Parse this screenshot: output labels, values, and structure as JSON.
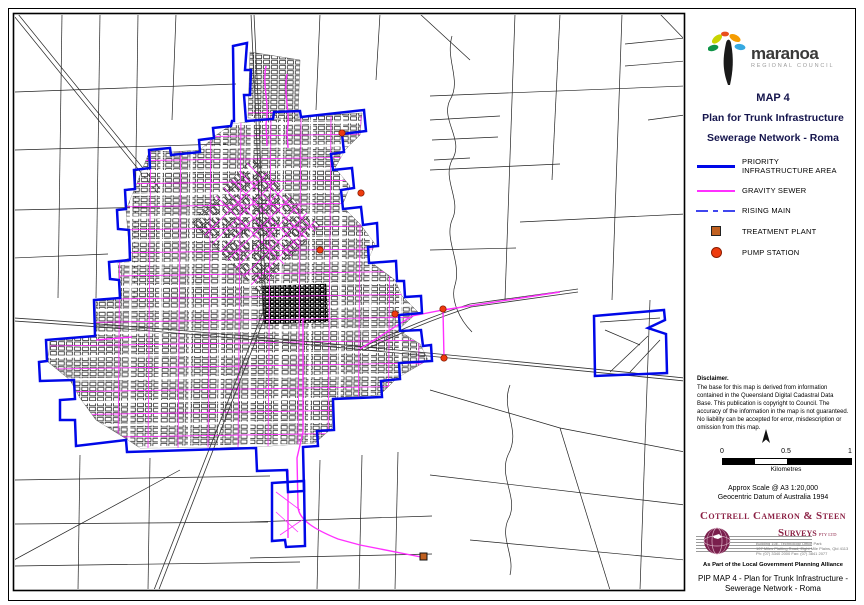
{
  "council_logo": {
    "name": "maranoa",
    "tagline": "REGIONAL COUNCIL"
  },
  "title_block": {
    "map_number": "MAP 4",
    "title": "Plan for Trunk Infrastructure",
    "subtitle": "Sewerage Network - Roma"
  },
  "legend": {
    "items": [
      {
        "id": "priority-infrastructure-area",
        "label": "PRIORITY INFRASTRUCTURE AREA"
      },
      {
        "id": "gravity-sewer",
        "label": "GRAVITY SEWER"
      },
      {
        "id": "rising-main",
        "label": "RISING MAIN"
      },
      {
        "id": "treatment-plant",
        "label": "TREATMENT PLANT"
      },
      {
        "id": "pump-station",
        "label": "PUMP STATION"
      }
    ]
  },
  "disclaimer": {
    "heading": "Disclaimer.",
    "body": "The base for this map is derived from information contained in the Queensland Digital Cadastral Data Base. This publication is copyright to Council. The accuracy of the information in the map is not guaranteed. No liability can be accepted for error, misdescription or omission from this map."
  },
  "scale_bar": {
    "tick_labels": [
      "0",
      "0.5",
      "1"
    ],
    "unit": "Kilometres"
  },
  "scale_notes": {
    "line1": "Approx Scale @ A3 1:20,000",
    "line2": "Geocentric Datum of Australia 1994"
  },
  "surveyor": {
    "name_line1": "Cottrell Cameron & Steen",
    "name_line2": "Surveys",
    "name_suffix": "PTY LTD",
    "address_line1": "Building 10E, Technology Office Park",
    "address_line2": "107 Miles Platting Road, Eight Mile Plains, Qld 4113",
    "address_line3": "Ph: (07) 3340 2000   Fax: (07) 3841 2077",
    "alliance": "As Part of the Local Government Planning Alliance"
  },
  "footer": {
    "line1": "PIP MAP 4 - Plan for Trunk Infrastructure -",
    "line2": "Sewerage Network - Roma"
  },
  "colors": {
    "priority_area": "#0008e8",
    "gravity_sewer": "#ff30ff",
    "rising_main": "#0008e8",
    "pump_station": "#ee3b0e",
    "treatment_plant": "#c06020",
    "surveyor_maroon": "#8b2044",
    "title_text": "#15154d"
  }
}
